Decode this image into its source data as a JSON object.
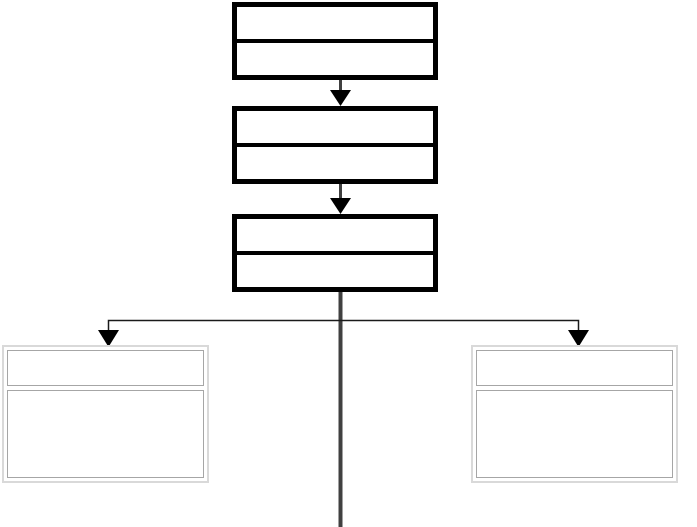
{
  "canvas": {
    "background": "#ffffff",
    "description": "empty flowchart wireframe: three two-row process nodes chained by down arrows, branching to two bordered panels and a trunk line to bottom edge"
  },
  "colors": {
    "canvas_background": "#ffffff",
    "node_border": "#000000",
    "node_fill": "#ffffff",
    "connector_stem": "#404040",
    "trunk_line": "#404040",
    "branch_line": "#1a1a1a",
    "arrowhead": "#000000",
    "panel_outer_border": "#d9d9d9",
    "panel_inner_border": "#a6a6a6",
    "panel_fill": "#ffffff"
  },
  "nodes": {
    "level1": {
      "title": "",
      "body": ""
    },
    "level2": {
      "title": "",
      "body": ""
    },
    "level3": {
      "title": "",
      "body": ""
    }
  },
  "panels": {
    "left": {
      "header": "",
      "body": ""
    },
    "right": {
      "header": "",
      "body": ""
    }
  }
}
